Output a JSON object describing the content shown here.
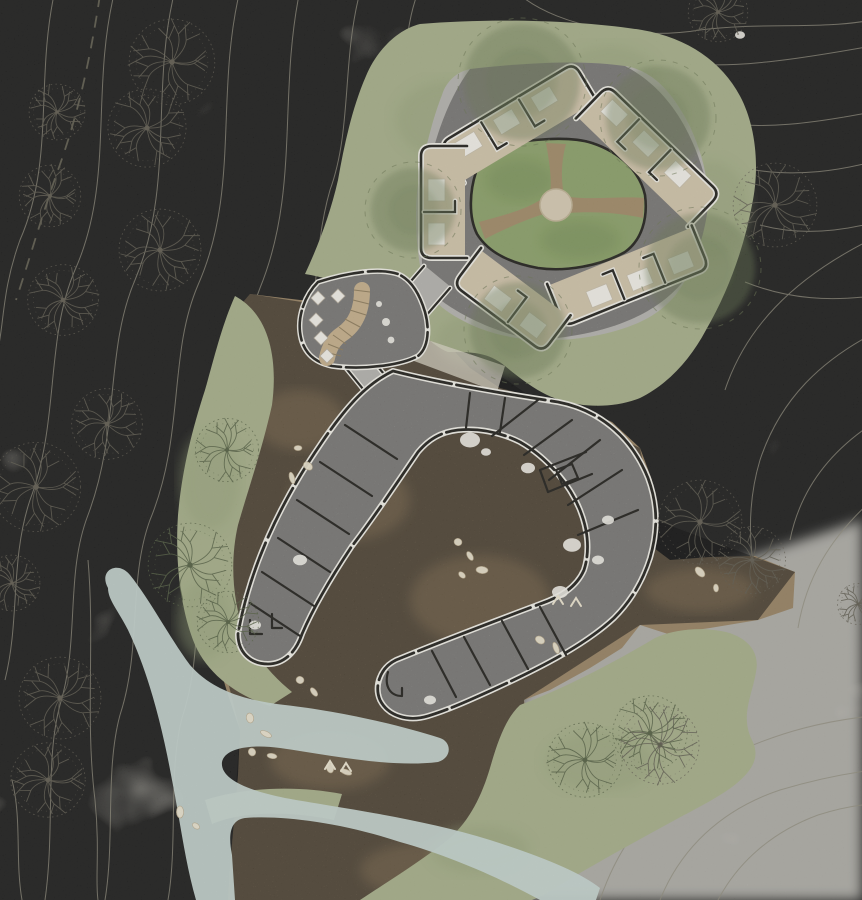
{
  "meta": {
    "title": "Architectural site plan — hillside resort masterplan with cabin ring, dining pavilion and main lodge building",
    "drawing_type": "site-plan"
  },
  "colors": {
    "paper": "#e7e4d8",
    "paper_light": "#efede4",
    "contour": "#8f8b79",
    "boundary": "#6a6655",
    "tree_gray": "#5c584b",
    "tree_green": "#505c3d",
    "meadow": "#a7b088",
    "meadow_deep": "#93a075",
    "courtyard_green": "#8ba266",
    "canopy": "#687850",
    "canopy_ring": "#66724c",
    "terrain": "#97805f",
    "terrain_deep": "#86704f",
    "path_brown": "#a28a64",
    "stream": "#c7d7d2",
    "concrete": "#b6b4af",
    "concrete_light": "#dcd7c7",
    "wall": "#1a1915",
    "wall_halo": "#f4f2ea",
    "room_floor": "#d4c6ab",
    "bed": "#f6f4ec",
    "deck": "#c7b08a",
    "deck_line": "#8d7a58",
    "plaza": "#d9cdb4",
    "pebble": "#efe7d0"
  },
  "landscape": {
    "contour_lines": true,
    "boundary_line": "dashed",
    "stream_present": true,
    "sketch_trees": [
      {
        "x": 172,
        "y": 62,
        "r": 46,
        "tint": "gray"
      },
      {
        "x": 147,
        "y": 128,
        "r": 42,
        "tint": "gray"
      },
      {
        "x": 57,
        "y": 112,
        "r": 30,
        "tint": "gray"
      },
      {
        "x": 50,
        "y": 196,
        "r": 33,
        "tint": "gray"
      },
      {
        "x": 160,
        "y": 250,
        "r": 44,
        "tint": "gray"
      },
      {
        "x": 63,
        "y": 300,
        "r": 38,
        "tint": "gray"
      },
      {
        "x": 107,
        "y": 424,
        "r": 38,
        "tint": "gray"
      },
      {
        "x": 36,
        "y": 487,
        "r": 48,
        "tint": "gray"
      },
      {
        "x": 12,
        "y": 583,
        "r": 30,
        "tint": "gray"
      },
      {
        "x": 60,
        "y": 698,
        "r": 44,
        "tint": "gray"
      },
      {
        "x": 48,
        "y": 780,
        "r": 40,
        "tint": "gray"
      },
      {
        "x": 775,
        "y": 205,
        "r": 45,
        "tint": "gray"
      },
      {
        "x": 718,
        "y": 12,
        "r": 32,
        "tint": "gray"
      },
      {
        "x": 700,
        "y": 522,
        "r": 45,
        "tint": "gray"
      },
      {
        "x": 752,
        "y": 560,
        "r": 36,
        "tint": "gray"
      },
      {
        "x": 858,
        "y": 604,
        "r": 22,
        "tint": "gray"
      },
      {
        "x": 660,
        "y": 745,
        "r": 42,
        "tint": "gray"
      },
      {
        "x": 227,
        "y": 450,
        "r": 34,
        "tint": "green"
      },
      {
        "x": 190,
        "y": 565,
        "r": 45,
        "tint": "green"
      },
      {
        "x": 228,
        "y": 622,
        "r": 33,
        "tint": "green"
      },
      {
        "x": 585,
        "y": 760,
        "r": 40,
        "tint": "green"
      },
      {
        "x": 650,
        "y": 733,
        "r": 40,
        "tint": "green"
      }
    ],
    "canopy_trees": [
      {
        "x": 522,
        "y": 82,
        "r": 58
      },
      {
        "x": 658,
        "y": 118,
        "r": 52
      },
      {
        "x": 700,
        "y": 268,
        "r": 55
      },
      {
        "x": 518,
        "y": 330,
        "r": 48
      },
      {
        "x": 413,
        "y": 210,
        "r": 42
      }
    ],
    "pebbles": [
      [
        298,
        448
      ],
      [
        308,
        466
      ],
      [
        292,
        478
      ],
      [
        458,
        542
      ],
      [
        470,
        556
      ],
      [
        482,
        570
      ],
      [
        462,
        575
      ],
      [
        250,
        718
      ],
      [
        266,
        734
      ],
      [
        252,
        752
      ],
      [
        272,
        756
      ],
      [
        700,
        572
      ],
      [
        716,
        588
      ],
      [
        540,
        640
      ],
      [
        556,
        648
      ],
      [
        300,
        680
      ],
      [
        314,
        692
      ],
      [
        180,
        812
      ],
      [
        196,
        826
      ],
      [
        330,
        768
      ],
      [
        346,
        772
      ]
    ],
    "chevron_marks": [
      [
        558,
        600
      ],
      [
        576,
        602
      ],
      [
        330,
        765
      ],
      [
        346,
        767
      ]
    ]
  },
  "upper_complex": {
    "description": "ring of cabin clusters around a green courtyard",
    "cabin_clusters": [
      {
        "x": 519,
        "y": 123,
        "angle": -31,
        "beds": 3
      },
      {
        "x": 648,
        "y": 156,
        "angle": 44,
        "beds": 3
      },
      {
        "x": 444,
        "y": 202,
        "angle": -90,
        "beds": 2
      },
      {
        "x": 628,
        "y": 276,
        "angle": 158,
        "beds": 3
      },
      {
        "x": 512,
        "y": 300,
        "angle": 217,
        "beds": 2
      }
    ],
    "plaza": {
      "x": 556,
      "y": 205,
      "r": 16
    },
    "courtyard_paths": 3
  },
  "pavilion": {
    "description": "dining pavilion with deck stair",
    "tables": [
      [
        318,
        298
      ],
      [
        338,
        296
      ],
      [
        316,
        320
      ],
      [
        321,
        338
      ],
      [
        327,
        356
      ]
    ],
    "deck_stairs": true
  },
  "main_building": {
    "description": "angular three-arm lodge with partitioned rooms",
    "white_features": [
      [
        470,
        440,
        10
      ],
      [
        528,
        468,
        7
      ],
      [
        572,
        545,
        9
      ],
      [
        598,
        560,
        6
      ],
      [
        560,
        592,
        8
      ],
      [
        300,
        560,
        7
      ],
      [
        255,
        625,
        6
      ],
      [
        430,
        700,
        6
      ],
      [
        608,
        520,
        6
      ],
      [
        486,
        452,
        5
      ],
      [
        740,
        35,
        5
      ]
    ]
  }
}
